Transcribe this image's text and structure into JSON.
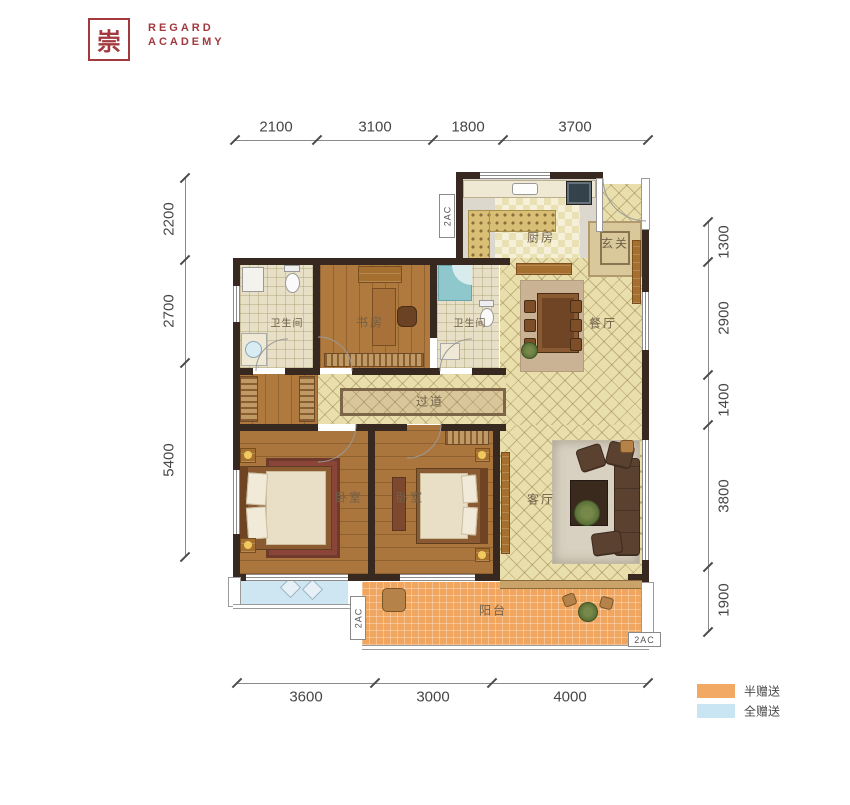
{
  "brand": {
    "seal_char": "崇",
    "name_line1": "REGARD",
    "name_line2": "ACADEMY"
  },
  "plan": {
    "rooms": {
      "kitchen": "厨房",
      "entry": "玄关",
      "bath1": "卫生间",
      "study": "书房",
      "bath2": "卫生间",
      "dining": "餐厅",
      "corridor": "过道",
      "bedroom1": "卧室",
      "bedroom2": "卧室",
      "living": "客厅",
      "balcony": "阳台"
    },
    "ac_unit_label": "2AC"
  },
  "dimensions": {
    "top": [
      "2100",
      "3100",
      "1800",
      "3700"
    ],
    "left": [
      "2200",
      "2700",
      "5400"
    ],
    "right": [
      "1300",
      "2900",
      "1400",
      "3800",
      "1900"
    ],
    "bottom": [
      "3600",
      "3000",
      "4000"
    ]
  },
  "legend": {
    "items": [
      {
        "label": "半赠送",
        "color": "#F2A963"
      },
      {
        "label": "全赠送",
        "color": "#C9E4F2"
      }
    ]
  },
  "colors": {
    "brand_red": "#A2393E",
    "wall": "#37291F",
    "tile_floor": "#E9DFAD",
    "wood_floor": "#AB763E",
    "half_gift_orange": "#F2A963",
    "full_gift_blue": "#C9E4F2"
  }
}
